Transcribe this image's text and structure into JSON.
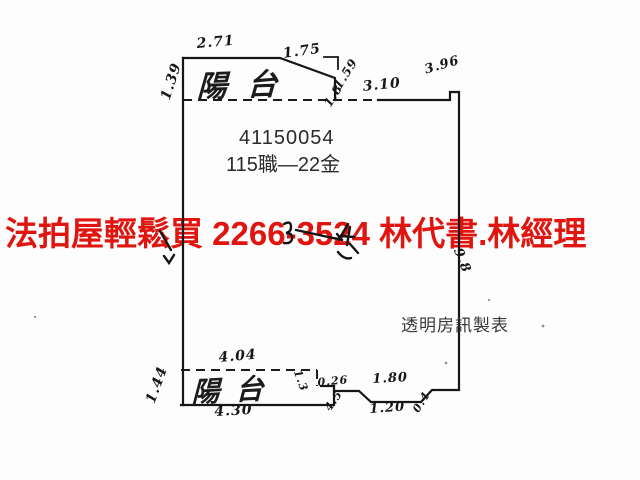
{
  "plan": {
    "unit_id": "41150054",
    "unit_label": "115職—22金",
    "maker_label": "透明房訊製表",
    "balcony_top_label": "陽台",
    "balcony_bottom_label": "陽台",
    "dimensions": {
      "top_width_left": "2.71",
      "top_width_right": "1.75",
      "left_height": "1.39",
      "slant_inner": "1.8",
      "slant_outer": "1.59",
      "top_wall": "3.10",
      "top_notch": "3.96",
      "right_wall": "9.8",
      "rear_top": "4.04",
      "rear_left": "1.44",
      "rear_bottom": "4.30",
      "step_left": "1.3",
      "step_top": "0.26",
      "step_diag": "4.5",
      "dip_top": "1.80",
      "dip_bottom": "1.20",
      "dip_side": "0.4"
    }
  },
  "overlay": {
    "ad_text": "法拍屋輕鬆買  2266-3524  林代書.林經理",
    "color": "#e11510"
  },
  "colors": {
    "line": "#161616",
    "paper": "#fdfdfd"
  }
}
